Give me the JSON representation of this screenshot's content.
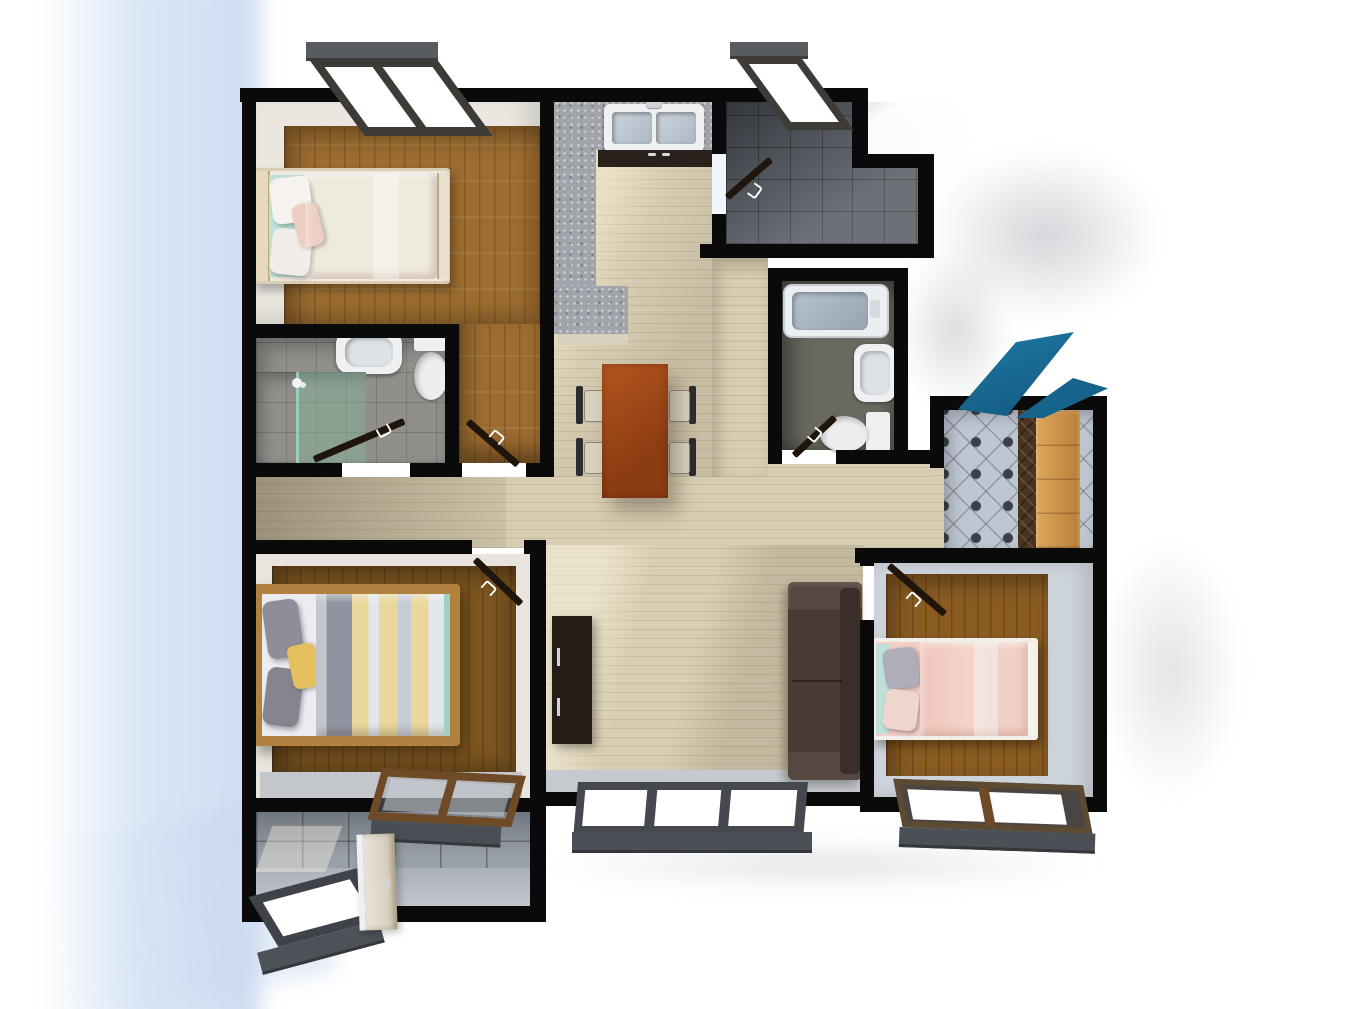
{
  "meta": {
    "title": "Top-down 3D render of an apartment floor plan",
    "view": "top-down axonometric",
    "visible_text": "none"
  },
  "colors": {
    "wall": "#0a0a0a",
    "floorLight": "#d7cdb2",
    "woodMid": "#9c6c30",
    "woodMaster": "#7c5520",
    "woodBed3": "#8a5c22",
    "granite": "#a2a4ac",
    "tileDark": "#585d65",
    "tileBath2": "#6a695f",
    "tileBath3": "#908f8b",
    "tileEntry": "#9aa0a8",
    "diamondTile": "#bec6d2",
    "diamondDot": "#3a4049",
    "accentBlue": "#1b6e94",
    "accentBlueDark": "#14577c",
    "cabinetWood": "#cc9850",
    "sofa": "#4a3a34",
    "console": "#251c15",
    "tableWood": "#a34b1b",
    "bedPink": "#f0c9b9",
    "bedPink2": "#f2cfc8",
    "stripeYellow": "#e9d79c",
    "stripeGray": "#9094a1",
    "teal": "#bfe0d8",
    "windowFrame": "#3f4349",
    "windowFace": "#4d5258",
    "doorPanel": "#20150c",
    "entryDoor": "#d9d1c0",
    "brownFrame": "#6e4a26",
    "shadowBlue": "#cfdef2"
  },
  "rooms": {
    "bedroom1": {
      "name": "bedroom (top-left, single bed)"
    },
    "kitchen": {
      "name": "kitchen (granite L-counter, double sink)"
    },
    "bathroom1": {
      "name": "bathroom (top-right, dark tile)"
    },
    "bathroom2": {
      "name": "bathroom (bathtub, sink, toilet)"
    },
    "bathroom3": {
      "name": "bathroom (shower, sink, toilet)"
    },
    "utility": {
      "name": "laundry / utility (diamond tile, wardrobe, ironing board)"
    },
    "dining": {
      "name": "dining area (table with four chairs)"
    },
    "living": {
      "name": "living area (sofa, TV console)"
    },
    "master": {
      "name": "master bedroom (striped double bed)"
    },
    "bedroom3": {
      "name": "bedroom (bottom-right, single bed)"
    },
    "entry": {
      "name": "entry / balcony (gray tile, open door)"
    },
    "hall": {
      "name": "hallway (light wood)"
    }
  },
  "objects": {
    "bed1": {
      "name": "single bed, pink bedding"
    },
    "bedMaster": {
      "name": "double bed, gray/yellow striped duvet"
    },
    "bed3": {
      "name": "single bed, pink bedding"
    },
    "sofa": {
      "name": "dark brown sofa"
    },
    "console": {
      "name": "TV console"
    },
    "table": {
      "name": "dining table"
    },
    "chairs": {
      "count": 4
    },
    "sinkKitchen": {
      "name": "double-basin kitchen sink"
    },
    "bathtub": {
      "name": "bathtub"
    },
    "shower": {
      "name": "glass shower enclosure"
    },
    "toilets": {
      "count": 2
    },
    "washbasins": {
      "count": 2
    },
    "wardrobe": {
      "name": "wooden wardrobe"
    },
    "ironingBoard": {
      "name": "blue ironing board"
    },
    "entryDoor": {
      "name": "open entry door"
    },
    "doors": {
      "count": 6
    },
    "windows": {
      "count": 6
    }
  }
}
